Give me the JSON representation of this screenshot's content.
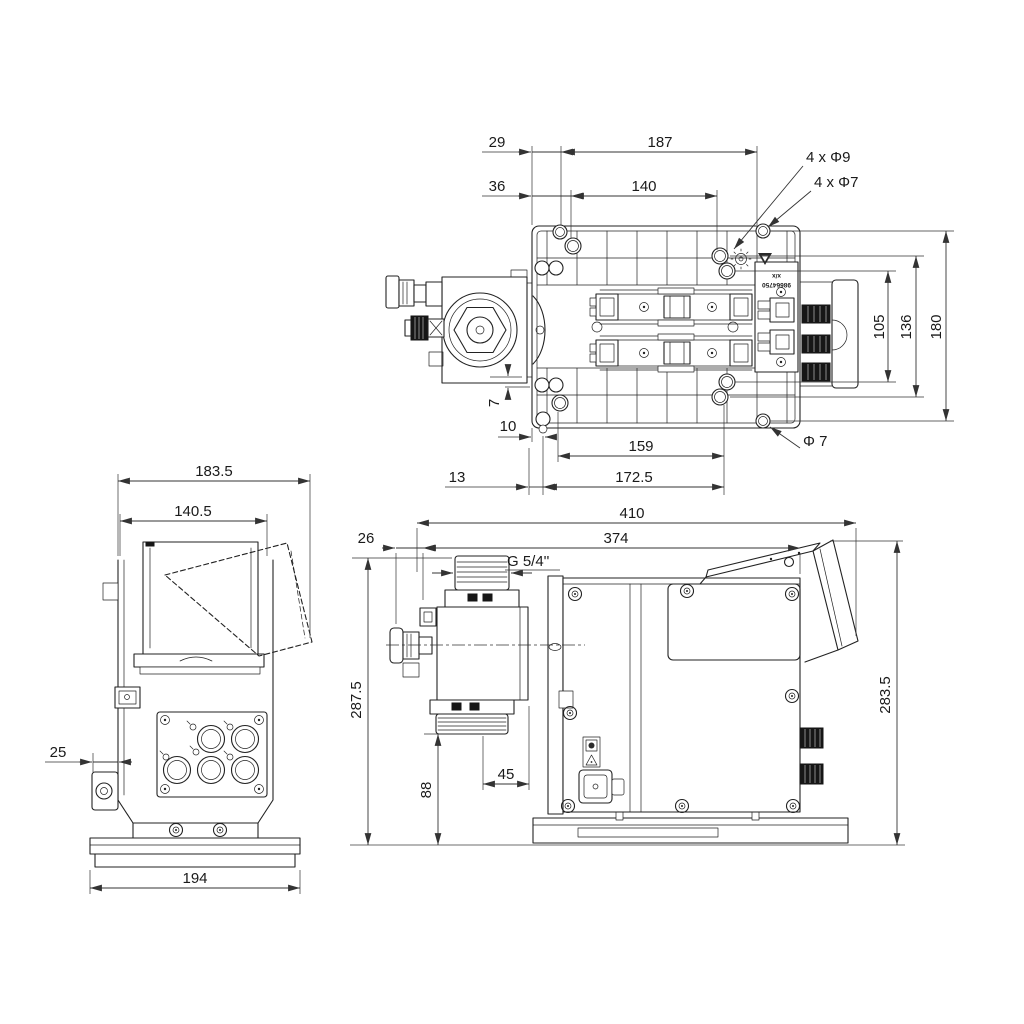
{
  "colors": {
    "line": "#222222",
    "dim_line": "#333333",
    "ground": "#8a8a8a",
    "background": "#ffffff",
    "knob_dark": "#161616"
  },
  "views": {
    "top": {
      "dims": {
        "d29": "29",
        "d187": "187",
        "d36": "36",
        "d140": "140",
        "holes9": "4 x Φ9",
        "holes7": "4 x Φ7",
        "d105": "105",
        "d136": "136",
        "d180": "180",
        "d7": "7",
        "d10": "10",
        "d159": "159",
        "dia7": "Φ 7",
        "d13": "13",
        "d172_5": "172.5"
      },
      "plate_label_line1": "x/x",
      "plate_label_line2": "98664750"
    },
    "side": {
      "dims": {
        "d183_5": "183.5",
        "d140_5": "140.5",
        "d25": "25",
        "d194": "194"
      }
    },
    "front": {
      "dims": {
        "d410": "410",
        "d26": "26",
        "d374": "374",
        "thread": "G 5/4''",
        "d287_5": "287.5",
        "d88": "88",
        "d45": "45",
        "d283_5": "283.5"
      }
    }
  }
}
